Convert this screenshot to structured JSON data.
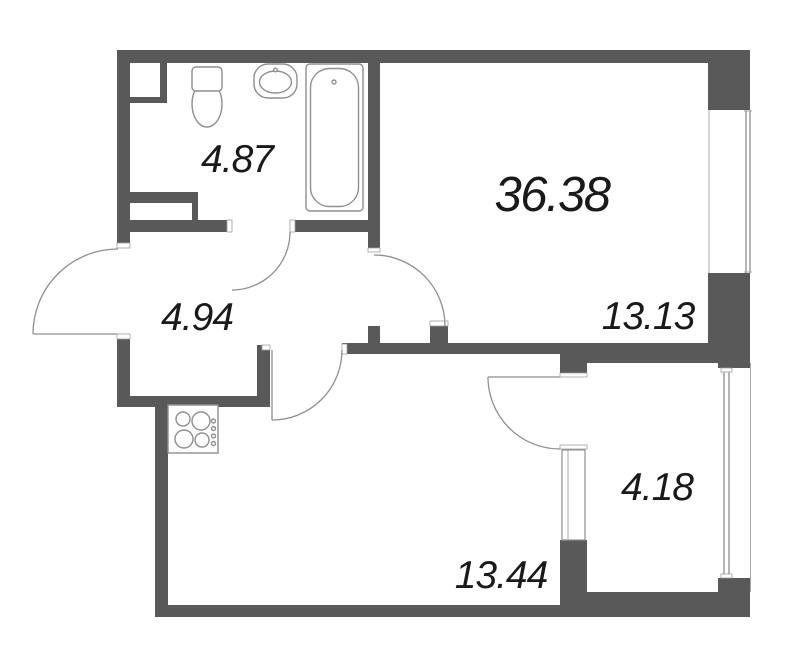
{
  "floor_plan": {
    "labels": {
      "total_area": "36.38",
      "bathroom_area": "4.87",
      "hallway_area": "4.94",
      "living_room_area": "13.13",
      "kitchen_area": "13.44",
      "balcony_area": "4.18"
    },
    "colors": {
      "wall": "#595959",
      "detail_line": "#8f8f8f",
      "label_text": "#1a1a1a",
      "background": "#ffffff"
    },
    "fixtures": [
      "toilet-icon",
      "sink-icon",
      "bathtub-icon",
      "stove-icon"
    ],
    "doors": [
      "entry-door",
      "bathroom-door",
      "living-room-door",
      "kitchen-door",
      "balcony-door"
    ],
    "windows": [
      "living-room-window",
      "balcony-glazing",
      "balcony-window-unit"
    ]
  }
}
